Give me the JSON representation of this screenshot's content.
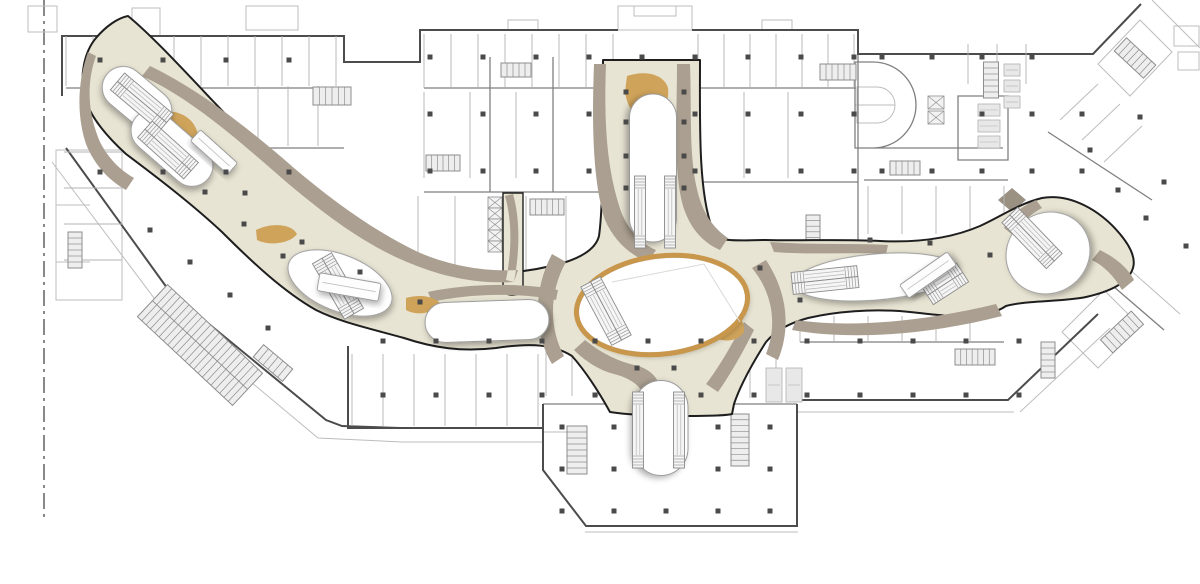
{
  "document": {
    "type": "architectural floor plan",
    "subject": "shopping mall concourse level with organic atrium walkways",
    "visible_text": []
  },
  "canvas": {
    "width": 1200,
    "height": 584
  },
  "palette": {
    "background": "#ffffff",
    "wall_light": "#bdbdbd",
    "wall_medium": "#7f7f7f",
    "wall_dark": "#4c4c4c",
    "concourse_outline": "#1e1e1e",
    "concourse_fill": "#e8e4d3",
    "band_taupe": "#aa9f90",
    "wood_tan": "#cfa35a",
    "atrium_ring_tan": "#c9974b",
    "void_stroke": "#9b9b9b",
    "void_fill": "#ffffff",
    "column": "#4a4a4a",
    "core_fill": "#eeeeee",
    "core_stroke": "#8d8d8d",
    "escalator_fill": "#f5f5f5",
    "escalator_stroke": "#8a8a8a",
    "fixture_fill": "#e8e8e8",
    "fixture_stroke": "#b0b0b0",
    "partition": "#b3b3b3",
    "deco_line": "#d9d9d6",
    "pylon_fill": "#9a9183"
  },
  "property_line": {
    "x": 44,
    "y_start": 0,
    "y_end": 520,
    "style": "dash-dot"
  },
  "voids": [
    {
      "id": "void-west-upper",
      "shape": "pill",
      "cx": 137,
      "cy": 99,
      "len": 78,
      "w": 42,
      "rot": 40
    },
    {
      "id": "void-west-lower",
      "shape": "pill",
      "cx": 172,
      "cy": 148,
      "len": 95,
      "w": 42,
      "rot": 41
    },
    {
      "id": "void-southwest",
      "shape": "ellipse",
      "cx": 340,
      "cy": 283,
      "rx": 55,
      "ry": 28,
      "rot": 22
    },
    {
      "id": "void-center-west",
      "shape": "pill",
      "cx": 487,
      "cy": 321,
      "len": 124,
      "w": 40,
      "rot": -2
    },
    {
      "id": "void-central-oval",
      "shape": "ellipse",
      "cx": 662,
      "cy": 305,
      "rx": 84,
      "ry": 47,
      "rot": -7,
      "ring": true
    },
    {
      "id": "void-north-keyhole",
      "shape": "pill",
      "cx": 653,
      "cy": 168,
      "len": 148,
      "w": 47,
      "rot": 90
    },
    {
      "id": "void-south-pill",
      "shape": "pill",
      "cx": 661,
      "cy": 428,
      "len": 95,
      "w": 54,
      "rot": 90
    },
    {
      "id": "void-east-lens",
      "shape": "ellipse",
      "cx": 876,
      "cy": 277,
      "rx": 83,
      "ry": 23,
      "rot": -5
    },
    {
      "id": "void-east-bulge",
      "shape": "ellipse",
      "cx": 1048,
      "cy": 253,
      "rx": 43,
      "ry": 40,
      "rot": -35
    }
  ],
  "escalators": [
    {
      "cx": 142,
      "cy": 102,
      "rot": 40,
      "len": 64,
      "tracks": 2
    },
    {
      "cx": 168,
      "cy": 150,
      "rot": 42,
      "len": 62,
      "tracks": 2
    },
    {
      "cx": 338,
      "cy": 286,
      "rot": 60,
      "len": 64,
      "tracks": 2
    },
    {
      "cx": 606,
      "cy": 311,
      "rot": 62,
      "len": 66,
      "tracks": 2
    },
    {
      "cx": 640,
      "cy": 212,
      "rot": 90,
      "len": 72,
      "tracks": 1
    },
    {
      "cx": 670,
      "cy": 212,
      "rot": 90,
      "len": 72,
      "tracks": 1
    },
    {
      "cx": 638,
      "cy": 430,
      "rot": 90,
      "len": 76,
      "tracks": 1
    },
    {
      "cx": 679,
      "cy": 430,
      "rot": 90,
      "len": 76,
      "tracks": 1
    },
    {
      "cx": 825,
      "cy": 280,
      "rot": -6,
      "len": 66,
      "tracks": 2
    },
    {
      "cx": 945,
      "cy": 284,
      "rot": -33,
      "len": 42,
      "tracks": 2
    },
    {
      "cx": 1032,
      "cy": 238,
      "rot": 46,
      "len": 64,
      "tracks": 2
    }
  ],
  "lifts": [
    {
      "cx": 349,
      "cy": 287,
      "rot": 10,
      "len": 62,
      "w": 18
    },
    {
      "cx": 214,
      "cy": 152,
      "rot": 42,
      "len": 50,
      "w": 15
    },
    {
      "cx": 928,
      "cy": 275,
      "rot": -35,
      "len": 58,
      "w": 16
    }
  ],
  "stairs": [
    {
      "cx": 332,
      "cy": 96,
      "rot": 0,
      "len": 38,
      "w": 18
    },
    {
      "cx": 443,
      "cy": 163,
      "rot": 0,
      "len": 34,
      "w": 16
    },
    {
      "cx": 516,
      "cy": 70,
      "rot": 0,
      "len": 30,
      "w": 14
    },
    {
      "cx": 547,
      "cy": 207,
      "rot": 0,
      "len": 34,
      "w": 16
    },
    {
      "cx": 813,
      "cy": 229,
      "rot": 90,
      "len": 28,
      "w": 14
    },
    {
      "cx": 838,
      "cy": 72,
      "rot": 0,
      "len": 36,
      "w": 16
    },
    {
      "cx": 991,
      "cy": 80,
      "rot": 90,
      "len": 36,
      "w": 15
    },
    {
      "cx": 1135,
      "cy": 58,
      "rot": 43,
      "len": 40,
      "w": 18
    },
    {
      "cx": 975,
      "cy": 357,
      "rot": 0,
      "len": 40,
      "w": 16
    },
    {
      "cx": 1048,
      "cy": 360,
      "rot": 90,
      "len": 36,
      "w": 14
    },
    {
      "cx": 273,
      "cy": 363,
      "rot": 40,
      "len": 38,
      "w": 16
    },
    {
      "cx": 577,
      "cy": 450,
      "rot": 90,
      "len": 48,
      "w": 20
    },
    {
      "cx": 740,
      "cy": 440,
      "rot": 90,
      "len": 52,
      "w": 18
    },
    {
      "cx": 75,
      "cy": 250,
      "rot": 90,
      "len": 36,
      "w": 14
    },
    {
      "cx": 1122,
      "cy": 332,
      "rot": -43,
      "len": 42,
      "w": 18
    },
    {
      "cx": 905,
      "cy": 168,
      "rot": 0,
      "len": 30,
      "w": 14
    },
    {
      "cx": 200,
      "cy": 345,
      "rot": 43,
      "len": 130,
      "w": 44
    }
  ],
  "shafts": [
    {
      "x": 928,
      "y": 96,
      "w": 16,
      "h": 13,
      "n": 2,
      "dy": 15
    },
    {
      "x": 488,
      "y": 197,
      "w": 14,
      "h": 11,
      "n": 5,
      "dy": 11
    }
  ],
  "fixtures": [
    [
      766,
      368,
      16,
      34
    ],
    [
      786,
      368,
      16,
      34
    ],
    [
      978,
      104,
      22,
      12
    ],
    [
      978,
      120,
      22,
      12
    ],
    [
      978,
      136,
      22,
      12
    ],
    [
      1004,
      64,
      16,
      12
    ],
    [
      1004,
      80,
      16,
      12
    ],
    [
      1004,
      96,
      16,
      12
    ]
  ],
  "column_grids": [
    {
      "x0": 100,
      "y0": 60,
      "dx": 63,
      "dy": 112,
      "nx": 4,
      "ny": 2
    },
    {
      "x0": 430,
      "y0": 57,
      "dx": 53,
      "dy": 57,
      "nx": 9,
      "ny": 3
    },
    {
      "x0": 882,
      "y0": 57,
      "dx": 50,
      "dy": 57,
      "nx": 5,
      "ny": 3
    },
    {
      "x0": 383,
      "y0": 341,
      "dx": 53,
      "dy": 54,
      "nx": 13,
      "ny": 2
    },
    {
      "x0": 562,
      "y0": 427,
      "dx": 52,
      "dy": 42,
      "nx": 5,
      "ny": 3
    }
  ],
  "column_skips": [
    [
      642,
      114
    ],
    [
      642,
      171
    ],
    [
      882,
      114
    ],
    [
      932,
      114
    ],
    [
      1082,
      57
    ],
    [
      648,
      395
    ],
    [
      666,
      427
    ],
    [
      666,
      469
    ]
  ],
  "column_extras": [
    [
      637,
      368
    ],
    [
      674,
      368
    ],
    [
      245,
      193
    ],
    [
      302,
      242
    ],
    [
      360,
      272
    ],
    [
      420,
      302
    ],
    [
      150,
      230
    ],
    [
      190,
      262
    ],
    [
      230,
      295
    ],
    [
      268,
      328
    ],
    [
      205,
      192
    ],
    [
      244,
      224
    ],
    [
      283,
      256
    ],
    [
      1090,
      150
    ],
    [
      1118,
      190
    ],
    [
      1146,
      218
    ],
    [
      1164,
      182
    ],
    [
      1186,
      246
    ],
    [
      1140,
      117
    ],
    [
      870,
      240
    ],
    [
      930,
      243
    ],
    [
      990,
      255
    ],
    [
      760,
      268
    ],
    [
      800,
      300
    ],
    [
      626,
      92
    ],
    [
      684,
      92
    ],
    [
      626,
      122
    ],
    [
      684,
      122
    ],
    [
      626,
      156
    ],
    [
      684,
      156
    ],
    [
      626,
      188
    ],
    [
      684,
      188
    ]
  ],
  "partition_strips": [
    {
      "x0": 66,
      "x1": 340,
      "y0": 36,
      "y1": 86,
      "step": 27,
      "dir": "v"
    },
    {
      "x0": 258,
      "x1": 344,
      "y0": 86,
      "y1": 146,
      "step": 30,
      "dir": "v"
    },
    {
      "x0": 424,
      "x1": 614,
      "y0": 34,
      "y1": 88,
      "step": 27,
      "dir": "v"
    },
    {
      "x0": 698,
      "x1": 856,
      "y0": 34,
      "y1": 88,
      "step": 26,
      "dir": "v"
    },
    {
      "x0": 700,
      "x1": 788,
      "y0": 92,
      "y1": 178,
      "step": 44,
      "dir": "v"
    },
    {
      "x0": 424,
      "x1": 560,
      "y0": 92,
      "y1": 178,
      "step": 46,
      "dir": "v"
    },
    {
      "x0": 968,
      "x1": 1040,
      "y0": 44,
      "y1": 84,
      "step": 29,
      "dir": "v"
    },
    {
      "x0": 800,
      "x1": 1000,
      "y0": 316,
      "y1": 342,
      "step": 34,
      "dir": "v"
    },
    {
      "x0": 724,
      "x1": 792,
      "y0": 336,
      "y1": 398,
      "step": 26,
      "dir": "v"
    },
    {
      "x0": 352,
      "x1": 540,
      "y0": 354,
      "y1": 426,
      "step": 31,
      "dir": "v"
    },
    {
      "x0": 546,
      "x1": 598,
      "y0": 340,
      "y1": 396,
      "step": 26,
      "dir": "v"
    },
    {
      "x0": 418,
      "x1": 470,
      "y0": 196,
      "y1": 270,
      "step": 37,
      "dir": "v"
    },
    {
      "x0": 526,
      "x1": 566,
      "y0": 196,
      "y1": 272,
      "step": 40,
      "dir": "v"
    },
    {
      "x0": 868,
      "x1": 1004,
      "y0": 186,
      "y1": 234,
      "step": 34,
      "dir": "v"
    },
    {
      "x0": 64,
      "x1": 122,
      "y0": 152,
      "y1": 260,
      "step": 36,
      "dir": "h"
    }
  ]
}
